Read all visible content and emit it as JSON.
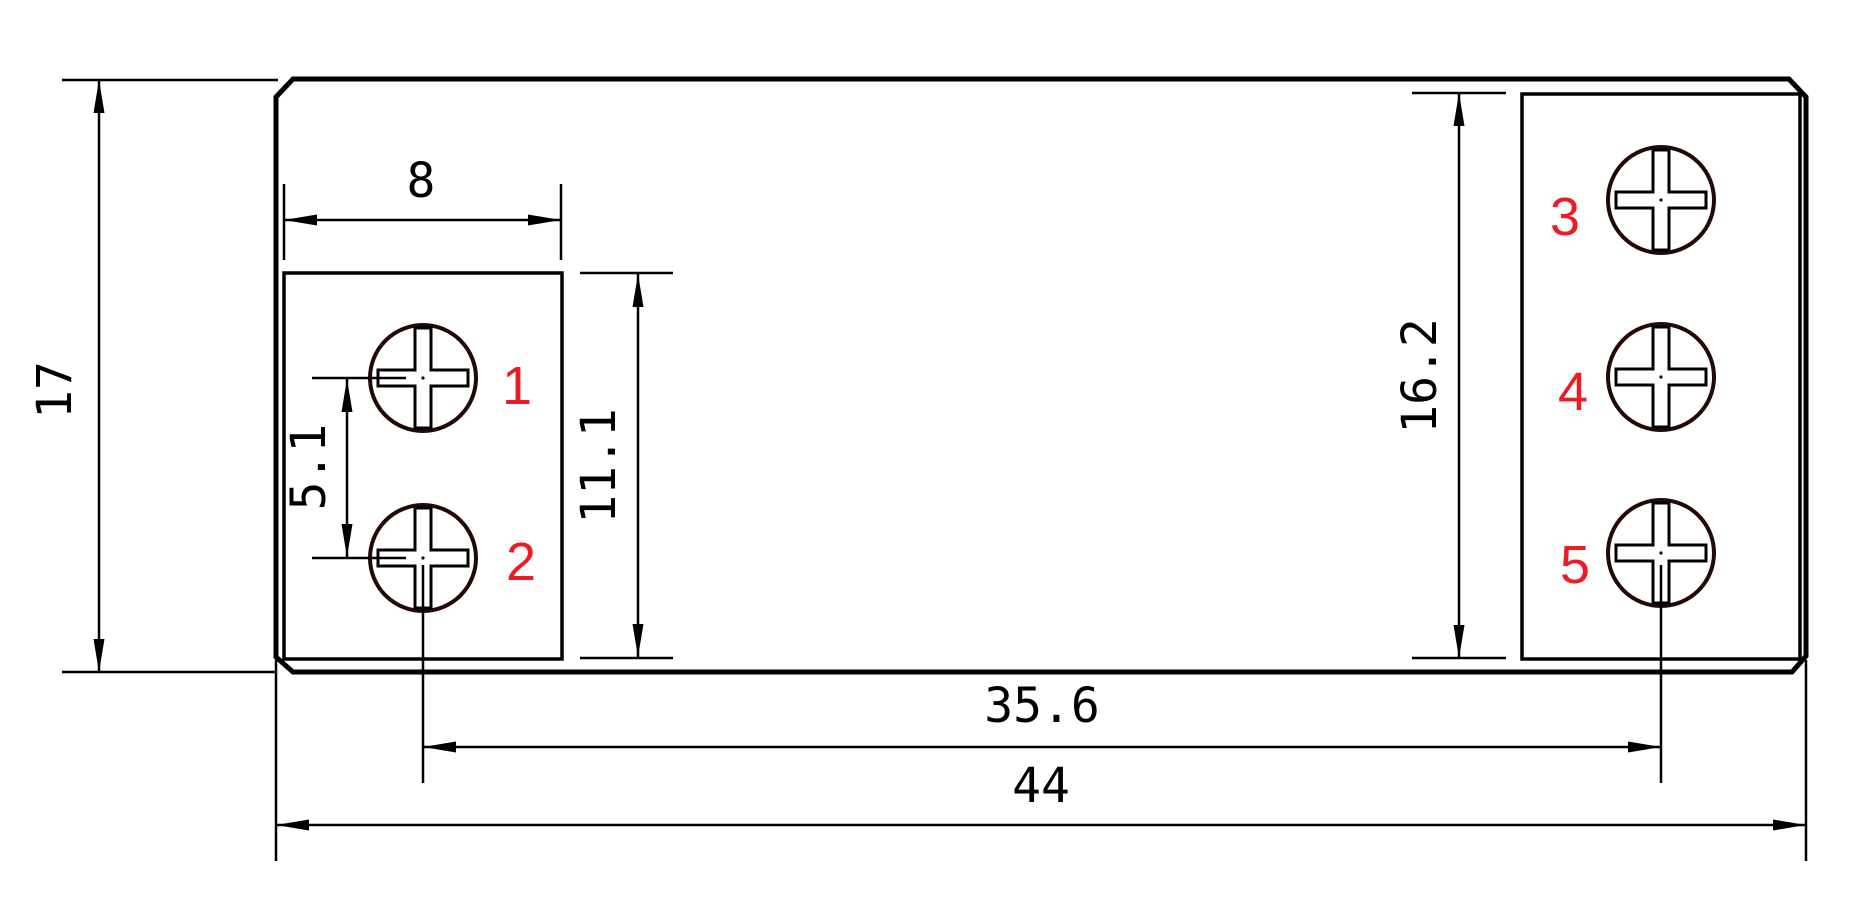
{
  "drawing": {
    "type": "mechanical-dimension-drawing",
    "background_color": "#ffffff",
    "colors": {
      "line": "#000000",
      "screw_outline": "#220807",
      "terminal_label": "#ed1c24"
    },
    "dimensions": {
      "overall_height": "17",
      "terminal_block_width": "8",
      "screw_pitch": "5.1",
      "left_block_height": "11.1",
      "right_block_height": "16.2",
      "screw_center_span": "35.6",
      "overall_width": "44"
    },
    "terminal_labels": [
      "1",
      "2",
      "3",
      "4",
      "5"
    ]
  }
}
